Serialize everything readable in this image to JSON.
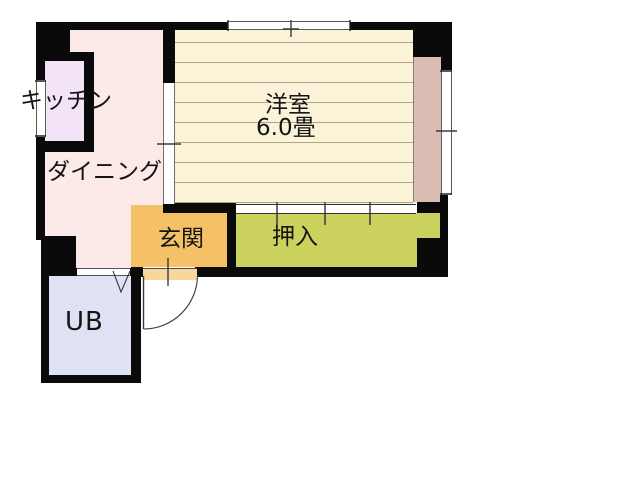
{
  "plan_type": "apartment-floorplan",
  "rooms": {
    "kitchen": {
      "label": "キッチン"
    },
    "dining": {
      "label": "ダイニング"
    },
    "western": {
      "label": "洋室",
      "size": "6.0畳"
    },
    "genkan": {
      "label": "玄関"
    },
    "closet": {
      "label": "押入"
    },
    "bath": {
      "label": "UB"
    }
  },
  "colors": {
    "wall": "#0a0a0a",
    "dining": "#fbeae8",
    "kitchen": "#f2e3f6",
    "western": "#faf3d8",
    "floor_line": "#b3a28d",
    "balcony": "#d9bdb3",
    "closet": "#cad25d",
    "genkan": "#f5c167",
    "threshold": "#f8d79c",
    "bath": "#dfe2f3",
    "mark_line": "#3a3a3a",
    "text": "#141414"
  }
}
